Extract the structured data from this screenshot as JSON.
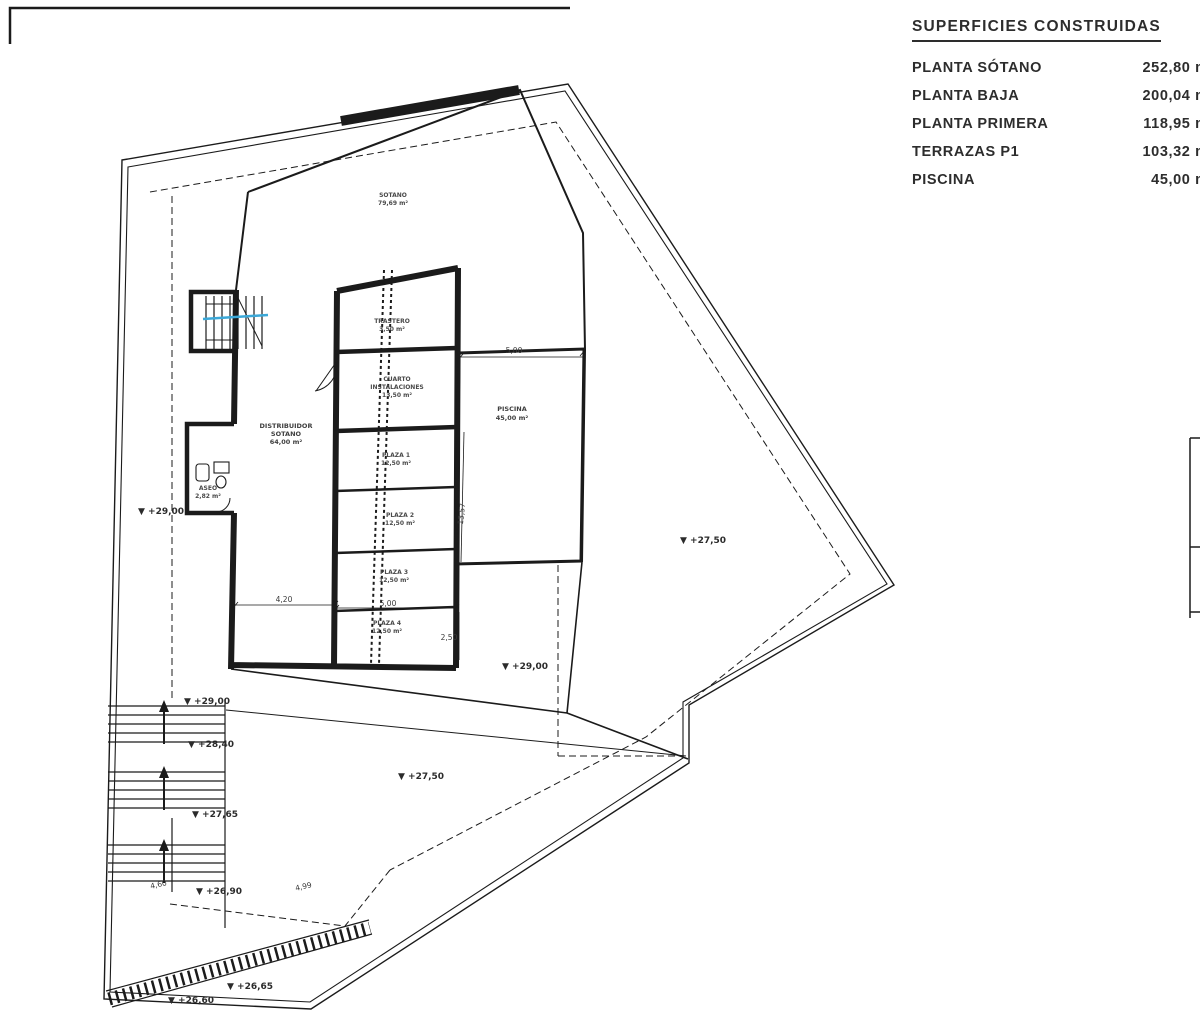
{
  "summary": {
    "title": "SUPERFICIES CONSTRUIDAS",
    "rows": [
      {
        "label": "PLANTA SÓTANO",
        "value": "252,80 m²"
      },
      {
        "label": "PLANTA BAJA",
        "value": "200,04 m²"
      },
      {
        "label": "PLANTA PRIMERA",
        "value": "118,95 m²"
      },
      {
        "label": "TERRAZAS P1",
        "value": "103,32 m²"
      },
      {
        "label": "PISCINA",
        "value": "45,00 m²"
      }
    ]
  },
  "plan": {
    "rooms": {
      "sotano": {
        "l1": "SOTANO",
        "l2": "79,69 m²"
      },
      "trastero": {
        "l1": "TRASTERO",
        "l2": "3,50 m²"
      },
      "cuarto": {
        "l1": "CUARTO",
        "l2": "INSTALACIONES",
        "l3": "13,50 m²"
      },
      "piscina": {
        "l1": "PISCINA",
        "l2": "45,00 m²"
      },
      "distribuidor": {
        "l1": "DISTRIBUIDOR",
        "l2": "SOTANO",
        "l3": "64,00 m²"
      },
      "plaza1": {
        "l1": "PLAZA 1",
        "l2": "12,50 m²"
      },
      "plaza2": {
        "l1": "PLAZA 2",
        "l2": "12,50 m²"
      },
      "plaza3": {
        "l1": "PLAZA 3",
        "l2": "12,50 m²"
      },
      "plaza4": {
        "l1": "PLAZA 4",
        "l2": "12,50 m²"
      },
      "aseo": {
        "l1": "ASEO",
        "l2": "2,82 m²"
      }
    },
    "levels": [
      "▼ +29,00",
      "▼ +27,50",
      "▼ +29,00",
      "▼ +29,00",
      "▼ +28,40",
      "▼ +27,50",
      "▼ +27,65",
      "▼ +26,90",
      "▼ +26,65",
      "▼ +26,60"
    ],
    "dims": {
      "pool_top": "5,00",
      "pool_side": "13,57",
      "dist": "4,20",
      "plaza": "5,00",
      "half": "2,50",
      "stair": "4,60",
      "walk": "4,99"
    }
  },
  "colors": {
    "ink": "#1b1b1b",
    "section_blue": "#3ba8d8",
    "paper": "#ffffff"
  }
}
